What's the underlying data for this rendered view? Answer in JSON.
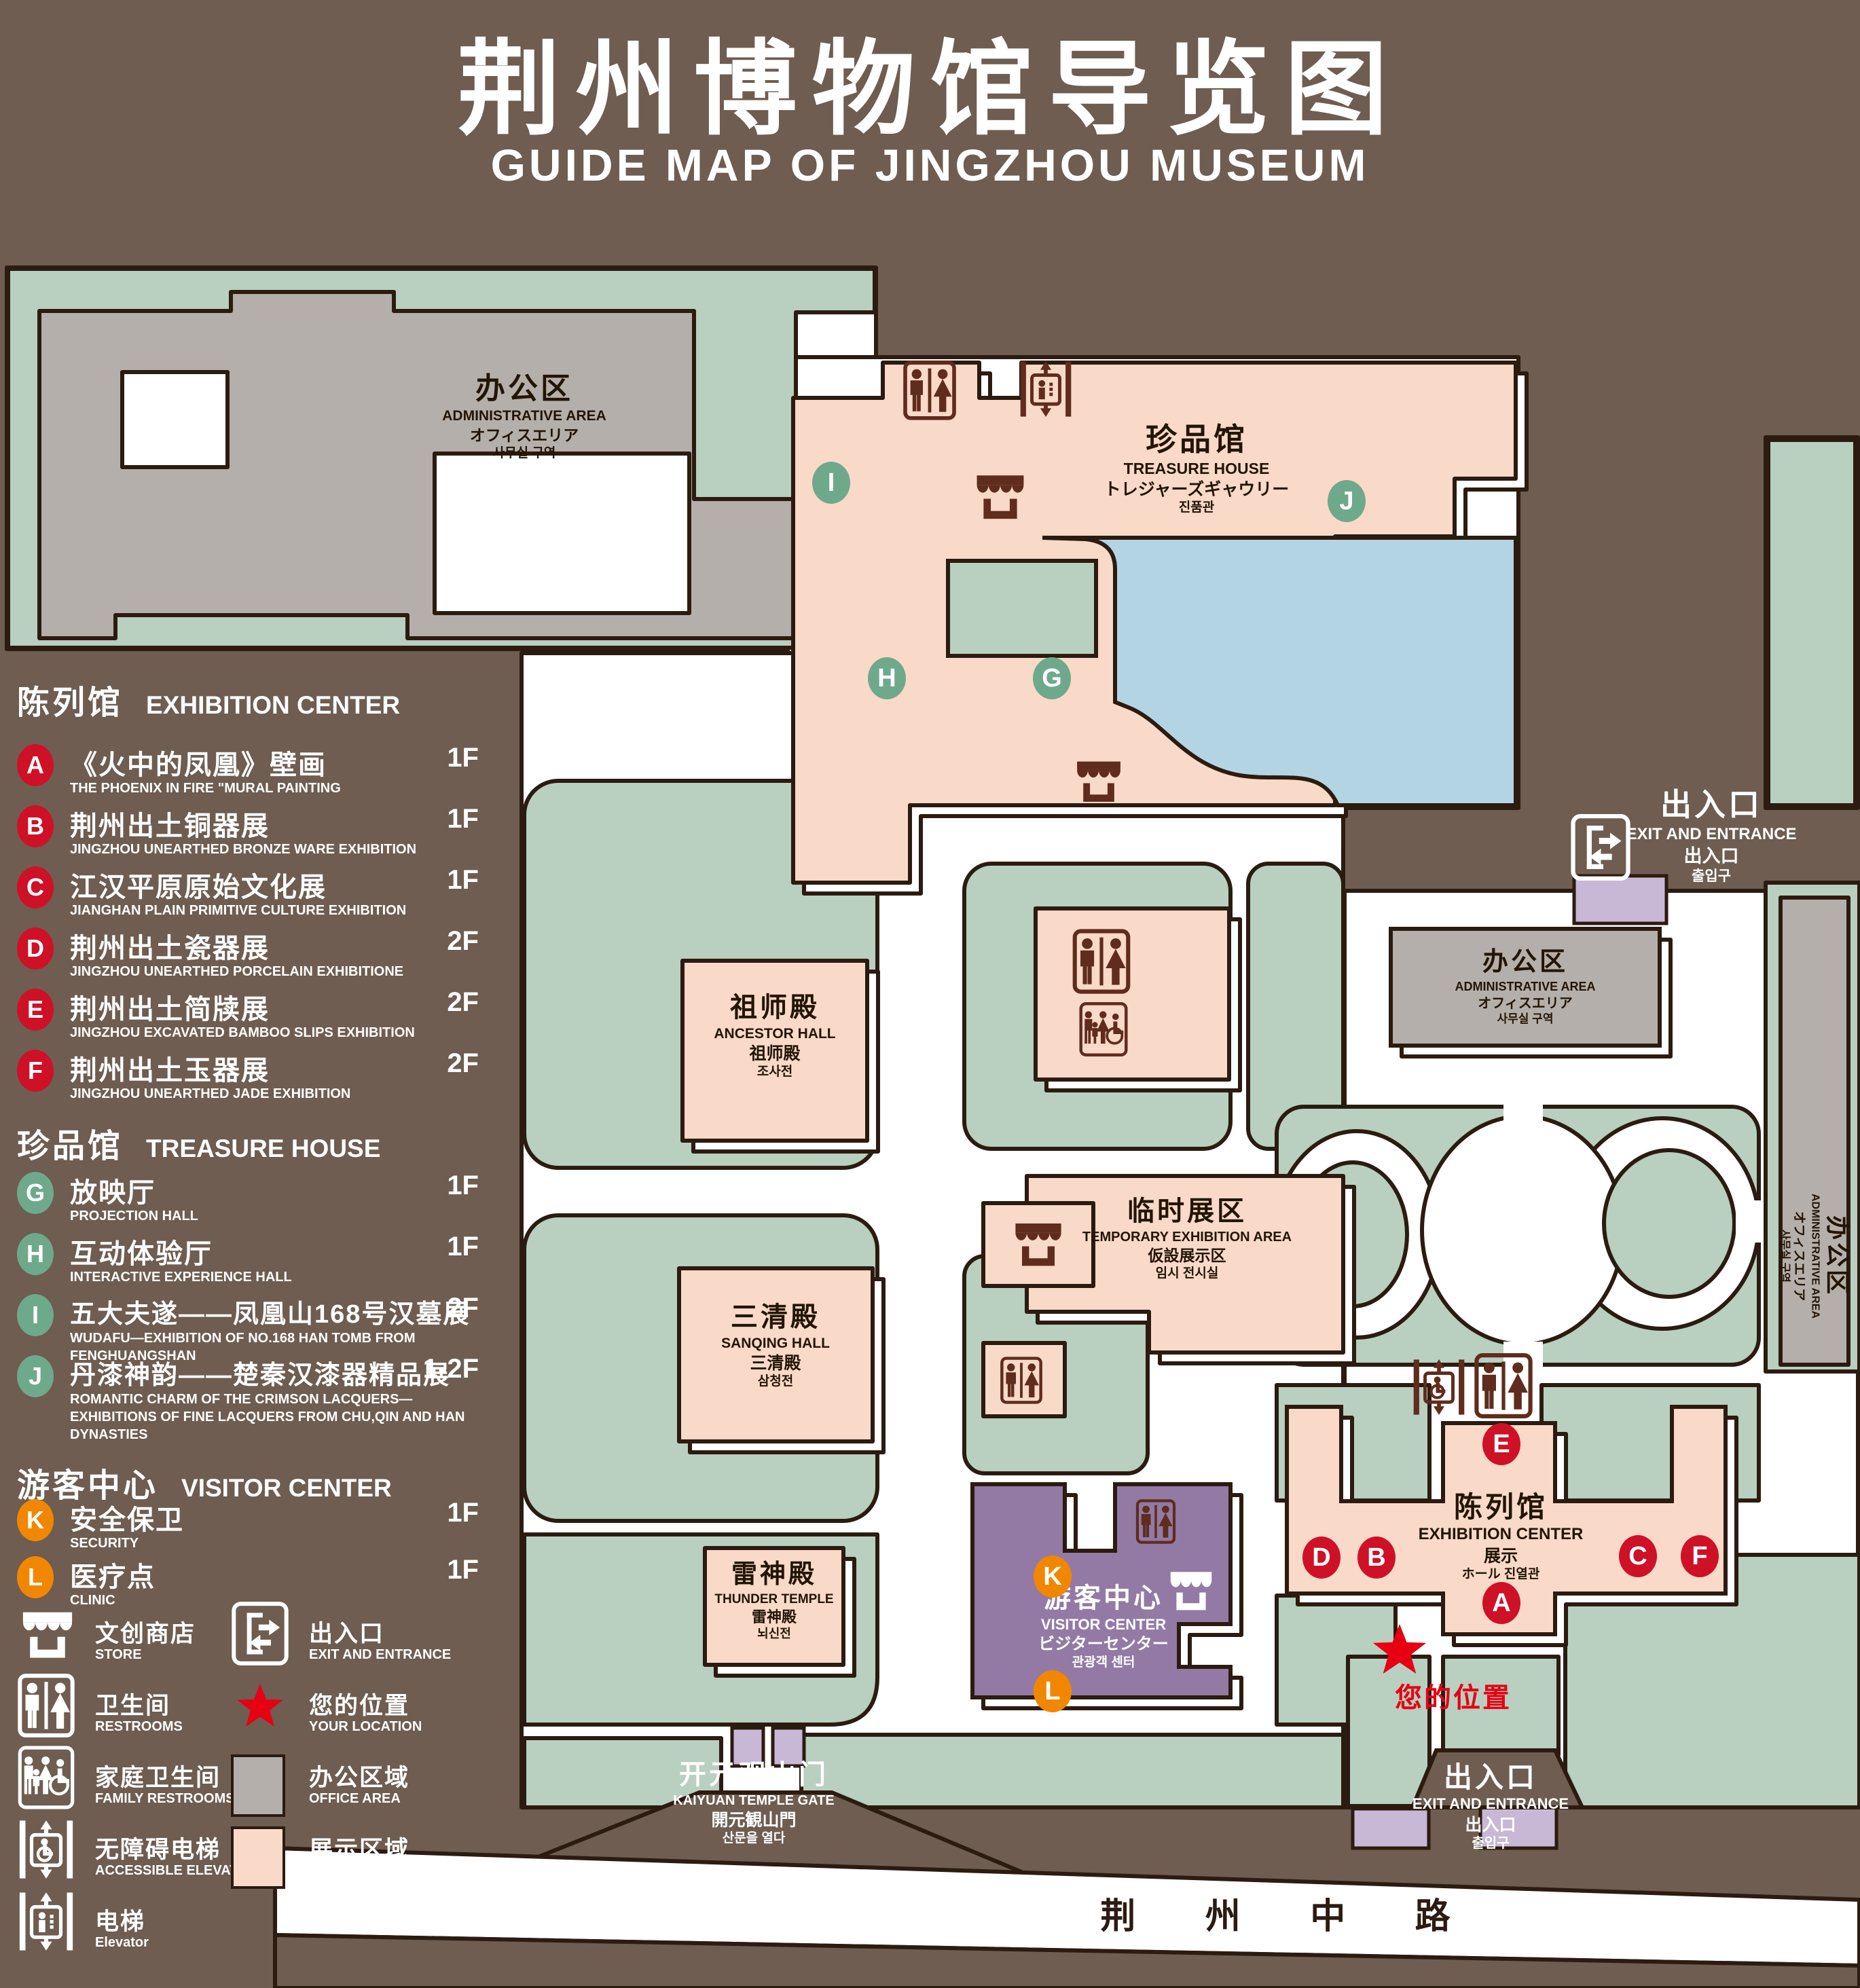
{
  "title": {
    "zh": "荆州博物馆导览图",
    "en": "GUIDE MAP OF JINGZHOU MUSEUM"
  },
  "colors": {
    "background": "#6E5D50",
    "outline": "#2B1B10",
    "green_area": "#B9CFC0",
    "display_area_pink": "#F9D9C7",
    "office_area_gray": "#B5AFAB",
    "pond_blue": "#B3D5E3",
    "visitor_center_purple": "#927AA5",
    "gate_light_purple": "#C9B7D6",
    "marker_red": "#CE1126",
    "marker_green": "#6FA98C",
    "marker_orange": "#F18700",
    "icon_maroon": "#5F2C1D",
    "location_red": "#E60012"
  },
  "sidebar": {
    "sections": [
      {
        "zh": "陈列馆",
        "en": "EXHIBITION CENTER",
        "items": [
          {
            "letter": "A",
            "zh": "《火中的凤凰》壁画",
            "en": "THE PHOENIX IN FIRE \"MURAL PAINTING",
            "floor": "1F"
          },
          {
            "letter": "B",
            "zh": "荆州出土铜器展",
            "en": "JINGZHOU UNEARTHED BRONZE WARE EXHIBITION",
            "floor": "1F"
          },
          {
            "letter": "C",
            "zh": "江汉平原原始文化展",
            "en": "JIANGHAN PLAIN PRIMITIVE CULTURE EXHIBITION",
            "floor": "1F"
          },
          {
            "letter": "D",
            "zh": "荆州出土瓷器展",
            "en": "JINGZHOU UNEARTHED PORCELAIN EXHIBITIONE",
            "floor": "2F"
          },
          {
            "letter": "E",
            "zh": "荆州出土简牍展",
            "en": "JINGZHOU EXCAVATED BAMBOO SLIPS EXHIBITION",
            "floor": "2F"
          },
          {
            "letter": "F",
            "zh": "荆州出土玉器展",
            "en": "JINGZHOU UNEARTHED JADE EXHIBITION",
            "floor": "2F"
          }
        ]
      },
      {
        "zh": "珍品馆",
        "en": "TREASURE HOUSE",
        "items": [
          {
            "letter": "G",
            "zh": "放映厅",
            "en": "PROJECTION HALL",
            "floor": "1F"
          },
          {
            "letter": "H",
            "zh": "互动体验厅",
            "en": "INTERACTIVE EXPERIENCE HALL",
            "floor": "1F"
          },
          {
            "letter": "I",
            "zh": "五大夫遂——凤凰山168号汉墓展",
            "en": "WUDAFU—EXHIBITION OF NO.168 HAN TOMB FROM FENGHUANGSHAN",
            "floor": "2F"
          },
          {
            "letter": "J",
            "zh": "丹漆神韵——楚秦汉漆器精品展",
            "en": "ROMANTIC CHARM OF THE CRIMSON LACQUERS—EXHIBITIONS OF FINE LACQUERS FROM CHU,QIN AND HAN DYNASTIES",
            "floor": "1-2F"
          }
        ]
      },
      {
        "zh": "游客中心",
        "en": "VISITOR CENTER",
        "items": [
          {
            "letter": "K",
            "zh": "安全保卫",
            "en": "SECURITY",
            "floor": "1F"
          },
          {
            "letter": "L",
            "zh": "医疗点",
            "en": "CLINIC",
            "floor": "1F"
          }
        ]
      }
    ],
    "legend": {
      "store": {
        "zh": "文创商店",
        "en": "STORE"
      },
      "restrooms": {
        "zh": "卫生间",
        "en": "RESTROOMS"
      },
      "family": {
        "zh": "家庭卫生间",
        "en": "FAMILY RESTROOMS"
      },
      "accessible_elevator": {
        "zh": "无障碍电梯",
        "en": "ACCESSIBLE ELEVATOR"
      },
      "elevator": {
        "zh": "电梯",
        "en": "Elevator"
      },
      "exit": {
        "zh": "出入口",
        "en": "EXIT AND ENTRANCE"
      },
      "location": {
        "zh": "您的位置",
        "en": "YOUR LOCATION"
      },
      "office": {
        "zh": "办公区域",
        "en": "OFFICE AREA"
      },
      "display": {
        "zh": "展示区域",
        "en": "DISPLAY AREA"
      }
    }
  },
  "map": {
    "admin_topleft": {
      "zh": "办公区",
      "en": "ADMINISTRATIVE AREA",
      "ja": "オフィスエリア",
      "ko": "사무실 구역"
    },
    "admin_mid": {
      "zh": "办公区",
      "en": "ADMINISTRATIVE AREA",
      "ja": "オフィスエリア",
      "ko": "사무실 구역"
    },
    "admin_right": {
      "zh": "办公区",
      "en": "ADMINISTRATIVE AREA",
      "ja": "オフィスエリア",
      "ko": "사무실 구역"
    },
    "treasure_house": {
      "zh": "珍品馆",
      "en": "TREASURE HOUSE",
      "ja": "トレジャーズギャウリー",
      "ko": "진품관"
    },
    "ancestor_hall": {
      "zh": "祖师殿",
      "en": "ANCESTOR HALL",
      "ja": "祖师殿",
      "ko": "조사전"
    },
    "temporary_exhibition": {
      "zh": "临时展区",
      "en": "TEMPORARY EXHIBITION AREA",
      "ja": "仮設展示区",
      "ko": "임시 전시실"
    },
    "sanqing_hall": {
      "zh": "三清殿",
      "en": "SANQING HALL",
      "ja": "三清殿",
      "ko": "삼청전"
    },
    "thunder_temple": {
      "zh": "雷神殿",
      "en": "THUNDER TEMPLE",
      "ja": "雷神殿",
      "ko": "뇌신전"
    },
    "visitor_center": {
      "zh": "游客中心",
      "en": "VISITOR CENTER",
      "ja": "ビジターセンター",
      "ko": "관광객 센터"
    },
    "exhibition_center": {
      "zh": "陈列馆",
      "en": "EXHIBITION CENTER",
      "ja": "展示",
      "ko": "ホール 진열관"
    },
    "kaiyuan_gate": {
      "zh": "开元观山门",
      "en": "KAIYUAN TEMPLE GATE",
      "ja": "開元観山門",
      "ko": "산문을 열다"
    },
    "exit_top": {
      "zh": "出入口",
      "en": "EXIT AND ENTRANCE",
      "ja": "出入口",
      "ko": "출입구"
    },
    "exit_bottom": {
      "zh": "出入口",
      "en": "EXIT AND ENTRANCE",
      "ja": "出入口",
      "ko": "출입구"
    },
    "road": {
      "zh": "荆 州 中 路"
    },
    "your_location": "您的位置",
    "markers": {
      "a": "A",
      "b": "B",
      "c": "C",
      "d": "D",
      "e": "E",
      "f": "F",
      "g": "G",
      "h": "H",
      "i": "I",
      "j": "J",
      "k": "K",
      "l": "L"
    }
  }
}
